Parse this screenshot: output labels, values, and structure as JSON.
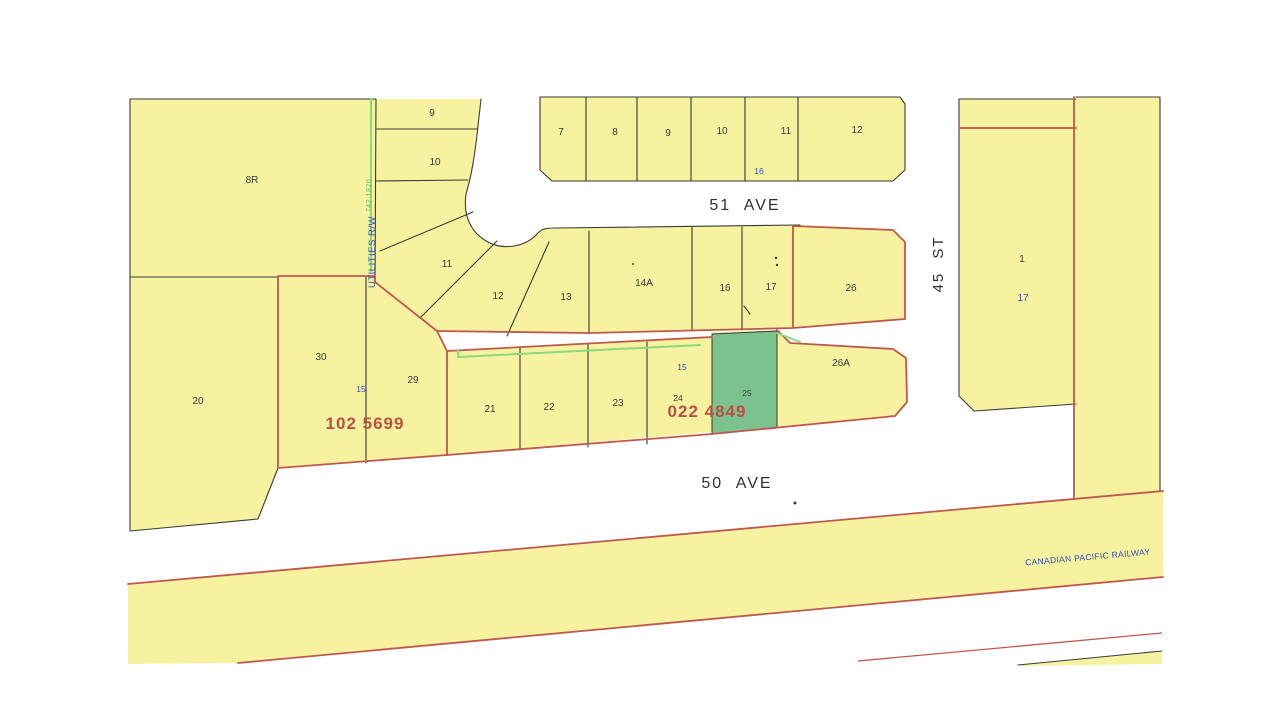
{
  "map": {
    "streets": {
      "ave51": "51 AVE",
      "ave50": "50 AVE",
      "st45": "45 ST"
    },
    "railway_label": "CANADIAN PACIFIC RAILWAY",
    "utilities_label": "UTILITIES R/W",
    "utilities_plan": "742 1820",
    "plan_numbers": {
      "left": "102 5699",
      "right": "022 4849"
    },
    "lots": {
      "r8": "8R",
      "w9": "9",
      "w10": "10",
      "t7": "7",
      "t8": "8",
      "t9": "9",
      "t10": "10",
      "t11": "11",
      "t12": "12",
      "t16_blue": "16",
      "m11": "11",
      "m12": "12",
      "m13": "13",
      "m14a": "14A",
      "m16": "16",
      "m17": "17",
      "m26": "26",
      "l20": "20",
      "l30": "30",
      "l29": "29",
      "l21": "21",
      "l22": "22",
      "l23": "23",
      "l24": "24",
      "l25": "25",
      "l26a": "26A",
      "rw15_left": "15",
      "rw15_right": "15",
      "e1": "1",
      "e17_blue": "17"
    }
  },
  "colors": {
    "lot_fill": "#f6f2a0",
    "highlight_fill": "#7cc28e",
    "boundary_red": "#c0584c",
    "parcel_black": "#3a3a38",
    "label_blue": "#2b50c0",
    "plan_text_red": "#bb4f46",
    "rw_line_green": "#8cd97c",
    "plan_text_green": "#66bb66"
  }
}
